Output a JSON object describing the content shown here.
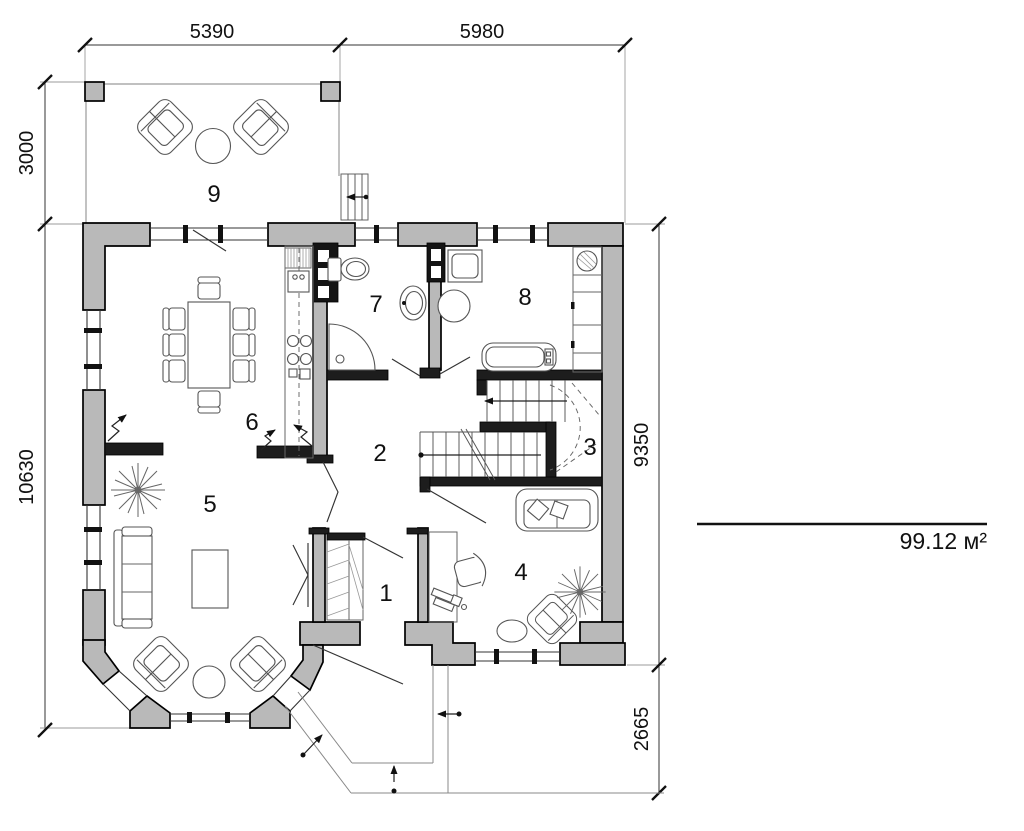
{
  "floor_plan": {
    "dimensions": {
      "top_left_span": "5390",
      "top_right_span": "5980",
      "left_terrace_depth": "3000",
      "left_house_height": "10630",
      "right_house_height": "9350",
      "right_porch_depth": "2665"
    },
    "rooms": {
      "r1": "1",
      "r2": "2",
      "r3": "3",
      "r4": "4",
      "r5": "5",
      "r6": "6",
      "r7": "7",
      "r8": "8",
      "r9": "9"
    },
    "total_area": "99.12 м²"
  }
}
